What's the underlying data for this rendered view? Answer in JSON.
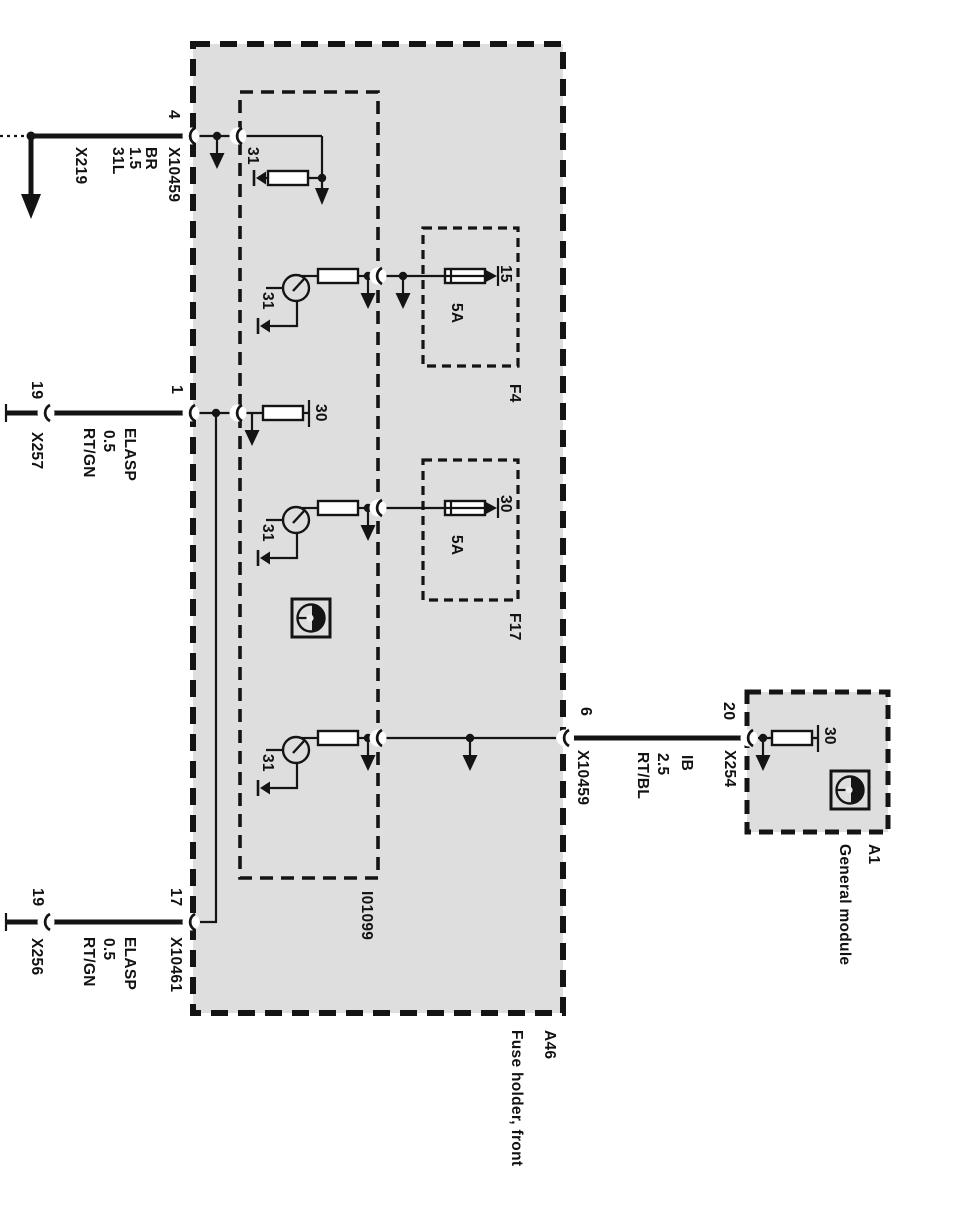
{
  "diagram": {
    "type": "wiring-schematic",
    "colors": {
      "module_fill": "#dedede",
      "line": "#141414",
      "background": "#ffffff"
    },
    "modules": {
      "a46": {
        "id": "A46",
        "name": "Fuse holder, front"
      },
      "i01099": {
        "id": "I01099"
      },
      "f4": {
        "id": "F4",
        "terminal": "15",
        "rating": "5A"
      },
      "f17": {
        "id": "F17",
        "terminal": "30",
        "rating": "5A"
      },
      "a1": {
        "id": "A1",
        "name": "General module",
        "terminal": "30"
      }
    },
    "terminals": {
      "t31": "31",
      "t30": "30"
    },
    "connections": {
      "pin4": {
        "pin": "4",
        "connector": "X10459",
        "wire": [
          "31L",
          "1.5",
          "BR"
        ],
        "ground_ref": "X219"
      },
      "pin1": {
        "pin": "1",
        "far_pin": "19",
        "far_connector": "X257",
        "wire": [
          "ELASP",
          "0.5",
          "RT/GN"
        ]
      },
      "pin17": {
        "pin": "17",
        "connector": "X10461",
        "far_pin": "19",
        "far_connector": "X256",
        "wire": [
          "ELASP",
          "0.5",
          "RT/GN"
        ]
      },
      "pin6": {
        "pin": "6",
        "connector": "X10459",
        "far_pin": "20",
        "far_connector": "X254",
        "wire": [
          "IB",
          "2.5",
          "RT/BL"
        ]
      }
    }
  }
}
